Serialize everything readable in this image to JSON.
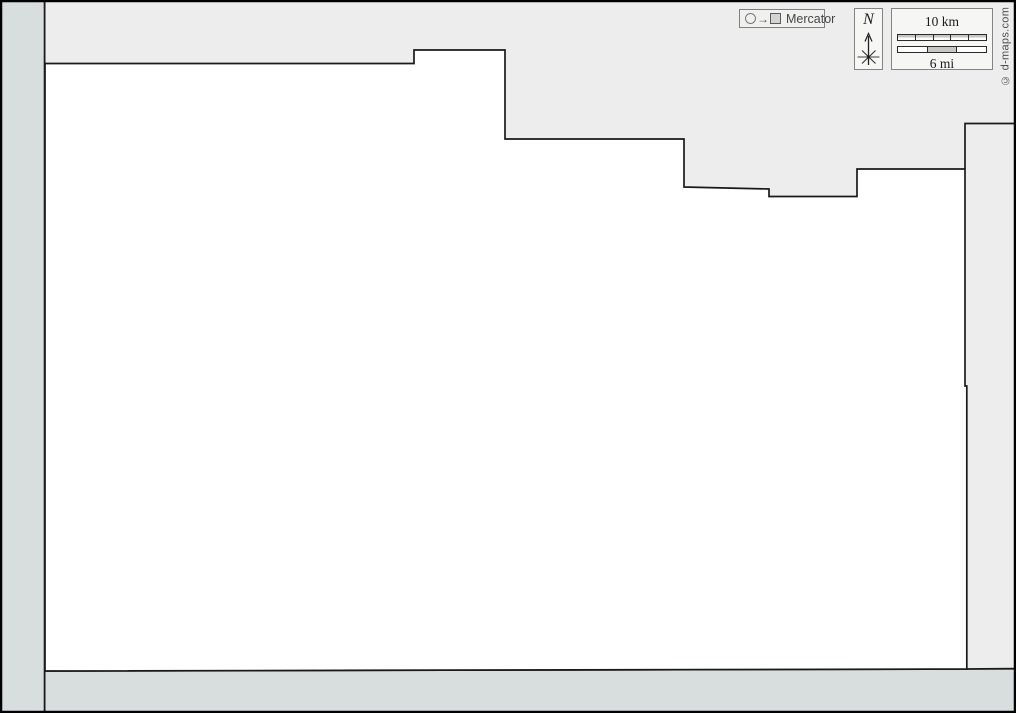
{
  "map": {
    "background_color": "#ededed",
    "strip_color": "#d7dedd",
    "region_fill": "#ffffff",
    "line_color": "#1a1a1a",
    "region_outline_points": "45,63.5 414,63.5 414,50 505,50 505,139 684,139 684,187 769,189 769,196.5 857,196.5 857,169 965,169 965,386 966.8,386 966.8,669 45,671",
    "neighbor_boundary_points": "965,169 965,123.5 1014,123.5",
    "bottom_strip_points": "45,671 966.8,669 1014,668.7 1014,711 45,711",
    "bottom_strip_topline_points": "45,671 966.8,669 1014,668.7"
  },
  "projection_badge": {
    "label": "Mercator"
  },
  "compass": {
    "north_label": "N"
  },
  "scale_bar": {
    "km_label": "10 km",
    "mi_label": "6 mi",
    "km_segments": 5,
    "mi_segments": 3
  },
  "copyright": "© d-maps.com"
}
